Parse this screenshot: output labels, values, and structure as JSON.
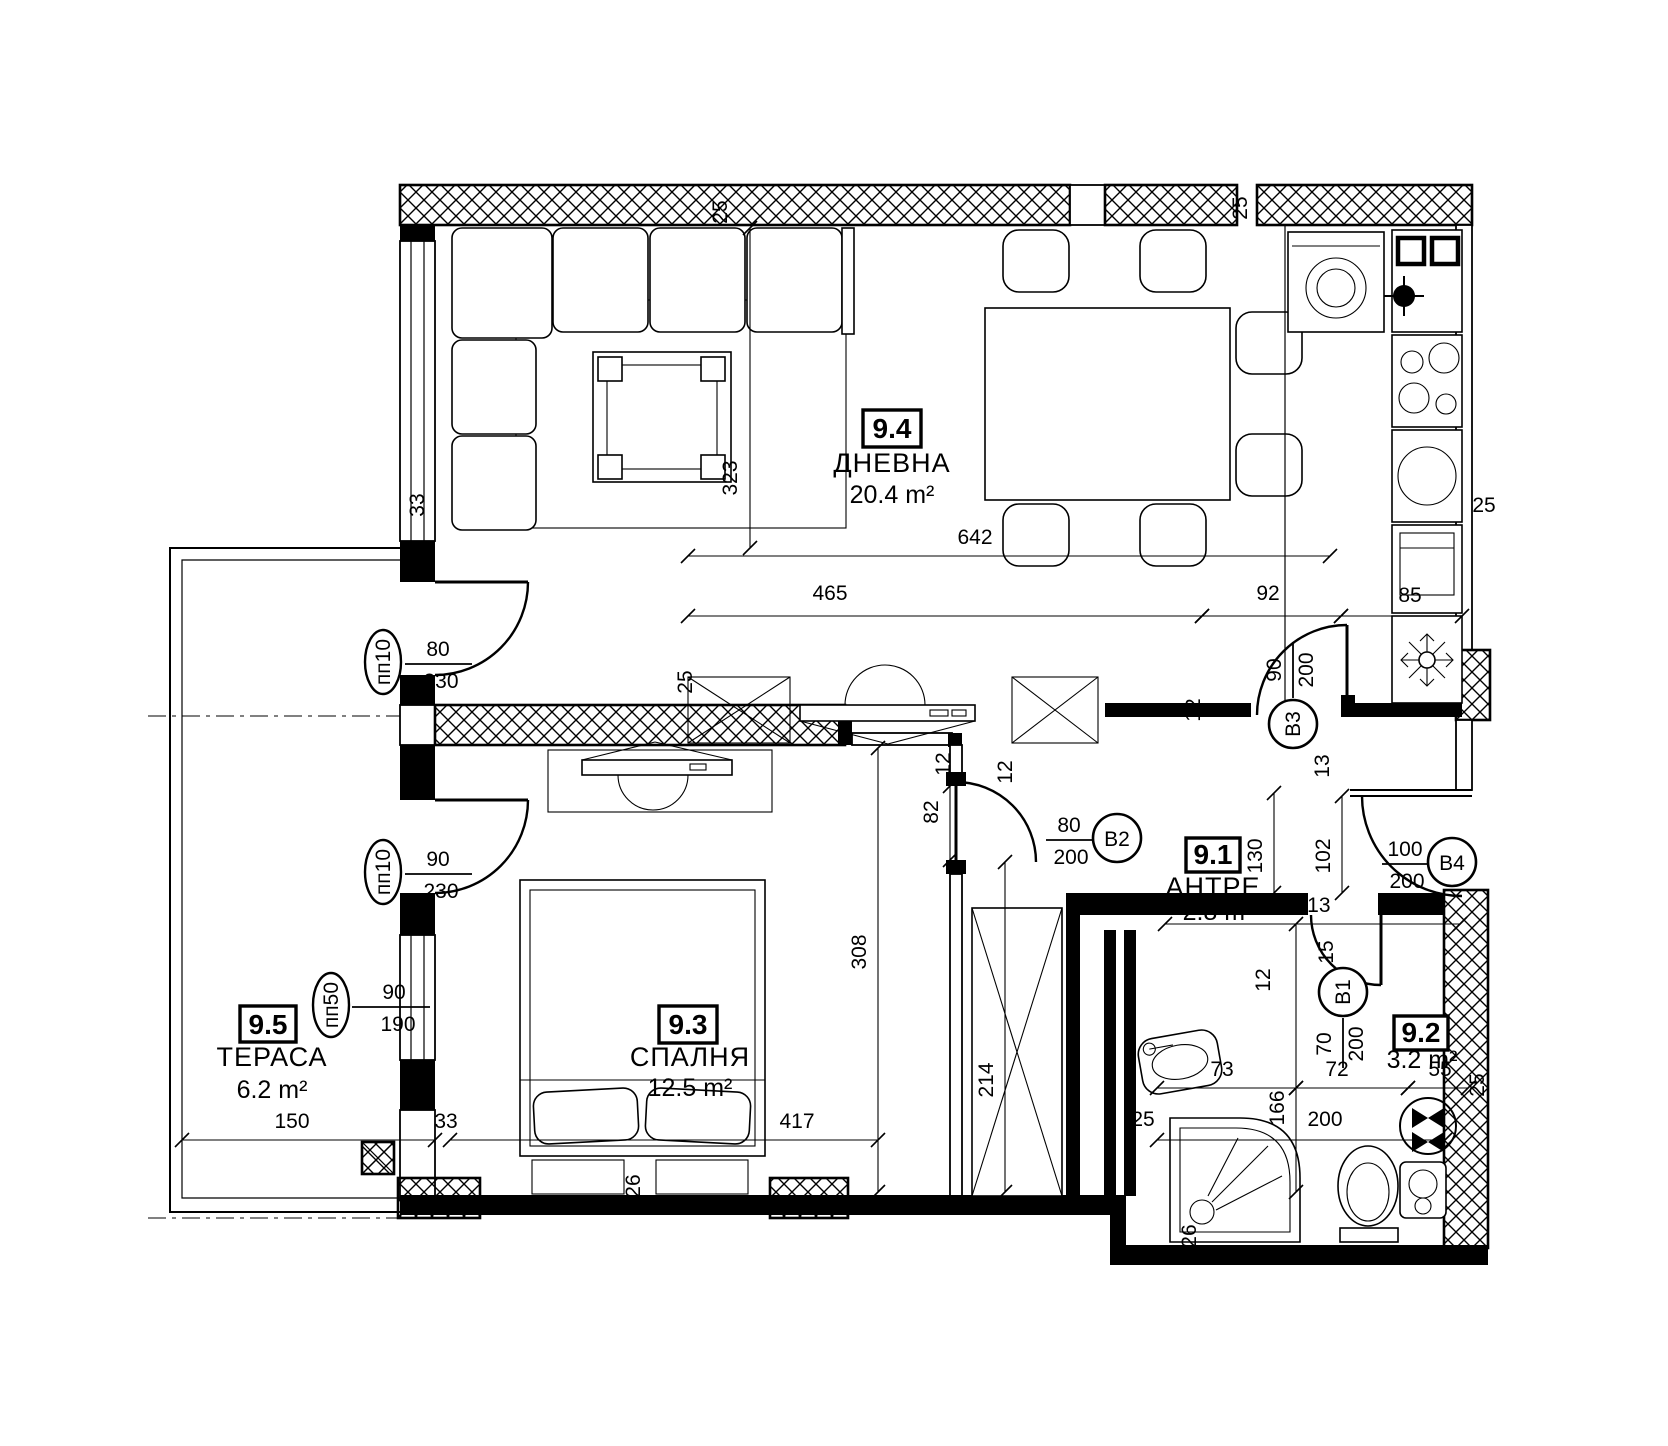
{
  "colors": {
    "ink": "#000000",
    "paper": "#ffffff"
  },
  "drawing": {
    "rooms": [
      {
        "id": "9.4",
        "name": "ДНЕВНА",
        "area": "20.4 m²"
      },
      {
        "id": "9.3",
        "name": "СПАЛНЯ",
        "area": "12.5 m²"
      },
      {
        "id": "9.1",
        "name": "АНТРЕ",
        "area": "2.8 m²"
      },
      {
        "id": "9.2",
        "name": "",
        "area": "3.2 m²"
      },
      {
        "id": "9.5",
        "name": "ТЕРАСА",
        "area": "6.2 m²"
      }
    ],
    "door_tags": [
      {
        "id": "B1",
        "w": "70",
        "h": "200"
      },
      {
        "id": "B2",
        "w": "80",
        "h": "200"
      },
      {
        "id": "B3",
        "w": "90",
        "h": "200"
      },
      {
        "id": "B4",
        "w": "100",
        "h": "200"
      }
    ],
    "window_tags": [
      {
        "id": "пп10",
        "w": "80",
        "h": "230"
      },
      {
        "id": "пп10",
        "w": "90",
        "h": "230"
      },
      {
        "id": "пп50",
        "w": "90",
        "h": "190"
      }
    ],
    "dims": [
      {
        "t": "25",
        "x": 727,
        "y": 212,
        "r": -90
      },
      {
        "t": "323",
        "x": 737,
        "y": 478,
        "r": -90,
        "line": [
          750,
          228,
          750,
          548
        ]
      },
      {
        "t": "642",
        "x": 975,
        "y": 544,
        "r": 0,
        "line": [
          688,
          556,
          1330,
          556
        ]
      },
      {
        "t": "465",
        "x": 830,
        "y": 600,
        "r": 0,
        "line": [
          688,
          616,
          1202,
          616
        ]
      },
      {
        "t": "92",
        "x": 1268,
        "y": 600,
        "r": 0,
        "line": [
          1202,
          616,
          1341,
          616
        ]
      },
      {
        "t": "85",
        "x": 1410,
        "y": 602,
        "r": 0,
        "line": [
          1341,
          616,
          1462,
          616
        ]
      },
      {
        "t": "25",
        "x": 1484,
        "y": 512,
        "r": 0
      },
      {
        "t": "33",
        "x": 424,
        "y": 505,
        "r": -90
      },
      {
        "t": "25",
        "x": 1247,
        "y": 208,
        "r": -90
      },
      {
        "t": "25",
        "x": 692,
        "y": 682,
        "r": -90
      },
      {
        "t": "12",
        "x": 950,
        "y": 764,
        "r": -90
      },
      {
        "t": "12",
        "x": 1012,
        "y": 772,
        "r": -90
      },
      {
        "t": "82",
        "x": 938,
        "y": 812,
        "r": -90,
        "line": [
          950,
          786,
          950,
          860
        ]
      },
      {
        "t": "308",
        "x": 866,
        "y": 952,
        "r": -90,
        "line": [
          878,
          748,
          878,
          1192
        ]
      },
      {
        "t": "214",
        "x": 993,
        "y": 1080,
        "r": -90,
        "line": [
          1005,
          862,
          1005,
          1192
        ]
      },
      {
        "t": "417",
        "x": 797,
        "y": 1128,
        "r": 0,
        "line": [
          450,
          1140,
          878,
          1140
        ]
      },
      {
        "t": "150",
        "x": 292,
        "y": 1128,
        "r": 0,
        "line": [
          182,
          1140,
          435,
          1140
        ]
      },
      {
        "t": "33",
        "x": 446,
        "y": 1128,
        "r": 0
      },
      {
        "t": "26",
        "x": 640,
        "y": 1186,
        "r": -90
      },
      {
        "t": "26",
        "x": 1196,
        "y": 1236,
        "r": -90
      },
      {
        "t": "130",
        "x": 1262,
        "y": 856,
        "r": -90,
        "line": [
          1274,
          793,
          1274,
          893
        ]
      },
      {
        "t": "102",
        "x": 1330,
        "y": 856,
        "r": -90,
        "line": [
          1342,
          796,
          1342,
          893
        ]
      },
      {
        "t": "13",
        "x": 1329,
        "y": 766,
        "r": -90
      },
      {
        "t": "213",
        "x": 1313,
        "y": 912,
        "r": 0,
        "line": [
          1165,
          924,
          1460,
          924
        ]
      },
      {
        "t": "12",
        "x": 1155,
        "y": 912,
        "r": 0
      },
      {
        "t": "12",
        "x": 1200,
        "y": 710,
        "r": -90
      },
      {
        "t": "15",
        "x": 1333,
        "y": 952,
        "r": -90
      },
      {
        "t": "12",
        "x": 1270,
        "y": 980,
        "r": -90
      },
      {
        "t": "25",
        "x": 1143,
        "y": 1126,
        "r": 0
      },
      {
        "t": "166",
        "x": 1284,
        "y": 1108,
        "r": -90,
        "line": [
          1296,
          924,
          1296,
          1192
        ]
      },
      {
        "t": "200",
        "x": 1325,
        "y": 1126,
        "r": 0,
        "line": [
          1157,
          1140,
          1445,
          1140
        ]
      },
      {
        "t": "73",
        "x": 1222,
        "y": 1076,
        "r": 0,
        "line": [
          1157,
          1088,
          1296,
          1088
        ]
      },
      {
        "t": "72",
        "x": 1337,
        "y": 1076,
        "r": 0,
        "line": [
          1296,
          1088,
          1408,
          1088
        ]
      },
      {
        "t": "55",
        "x": 1440,
        "y": 1076,
        "r": 0,
        "line": [
          1408,
          1088,
          1468,
          1088
        ]
      },
      {
        "t": "25",
        "x": 1484,
        "y": 1085,
        "r": -90
      }
    ]
  }
}
